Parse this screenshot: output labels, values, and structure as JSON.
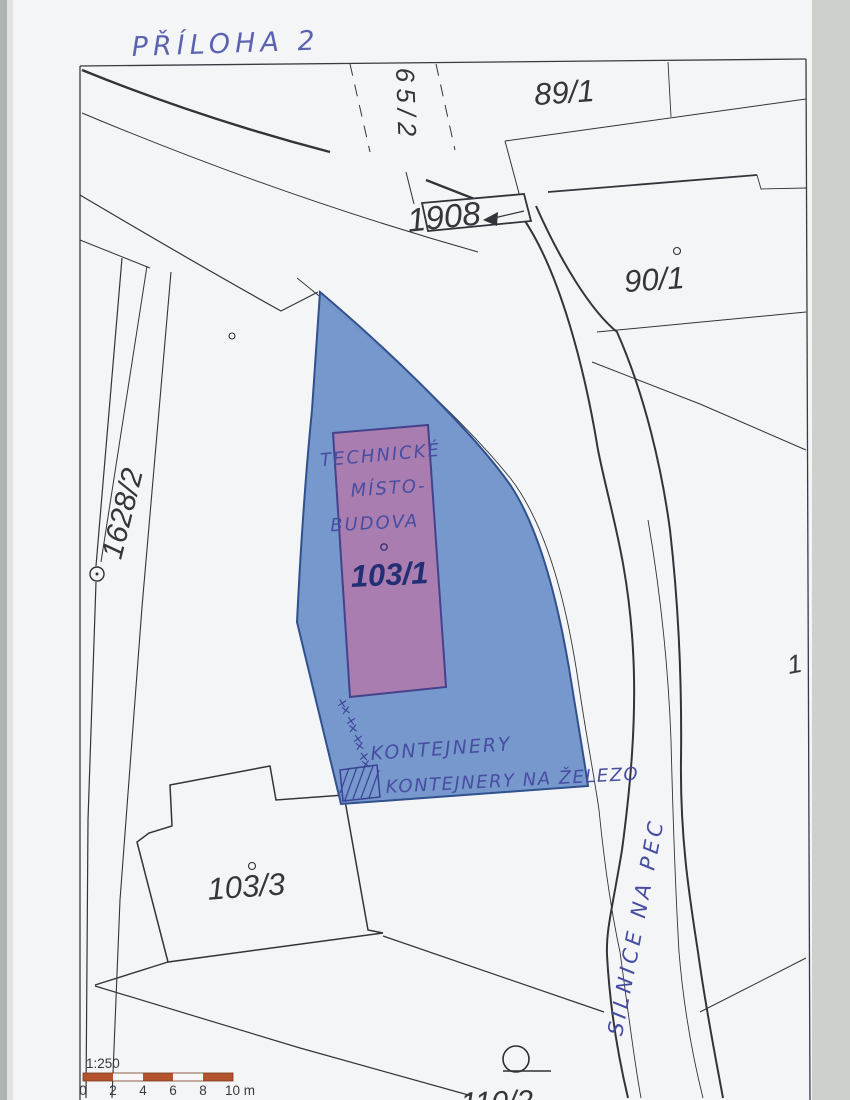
{
  "document": {
    "attachment_note": "PŘÍLOHA 2"
  },
  "parcels": {
    "p65_2": "65/2",
    "p89_1": "89/1",
    "road_1908": "1908",
    "p90_1": "90/1",
    "p1628_2": "1628/2",
    "p103_1": "103/1",
    "p103_3": "103/3",
    "p110_2": "110/2",
    "right_edge_partial": "1"
  },
  "annotations": {
    "building_note": [
      "TECHNICKÉ",
      "MÍSTO-",
      "BUDOVA"
    ],
    "containers_label": "KONTEJNERY",
    "metal_containers_label": "KONTEJNERY NA ŽELEZO",
    "road_name": "SILNICE NA PEC",
    "x_mark": "×"
  },
  "scale": {
    "ratio": "1:250",
    "ticks": [
      "0",
      "2",
      "4",
      "6",
      "8",
      "10 m"
    ]
  },
  "colors": {
    "highlighted_parcel_fill": "#7094cb",
    "building_fill": "#a97db0",
    "scale_bar_orange": "#b5532c",
    "handwriting_ink": "#474da0",
    "printed_label": "#35353b"
  }
}
